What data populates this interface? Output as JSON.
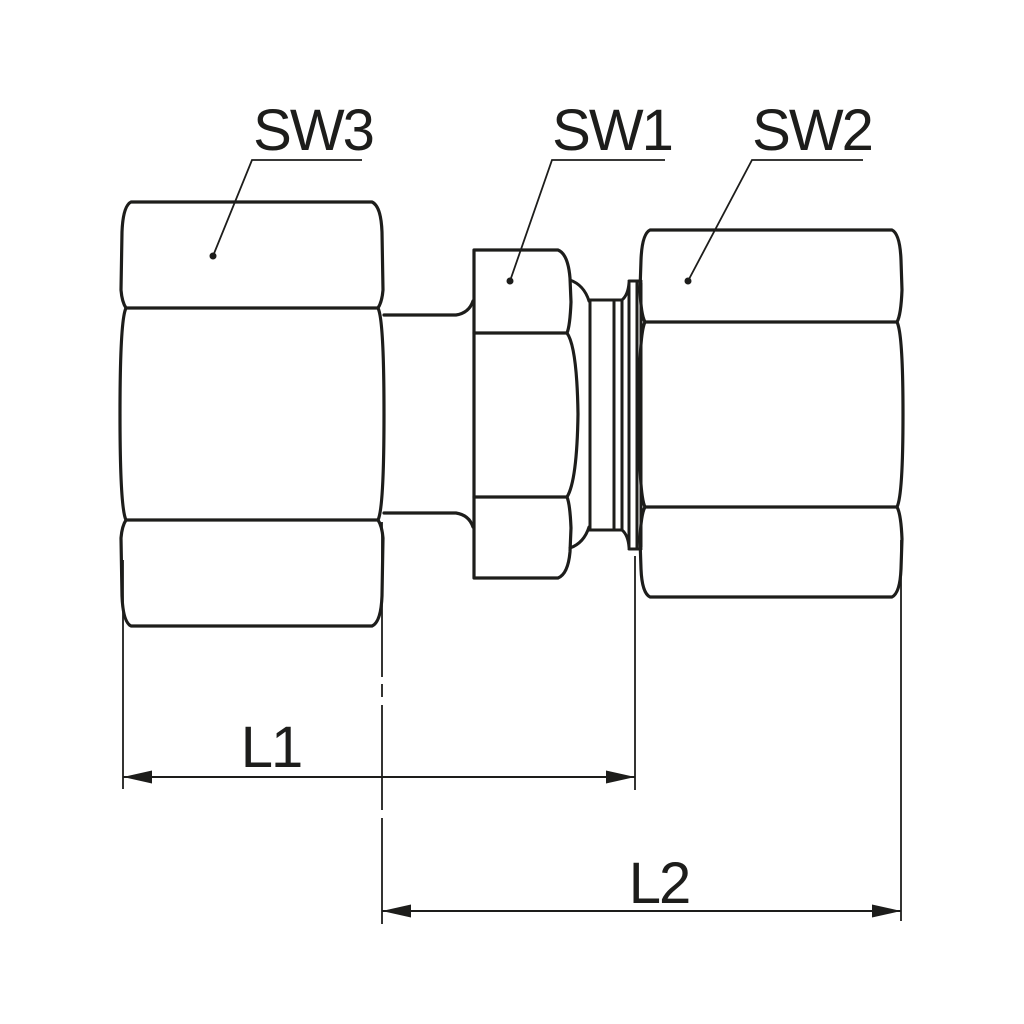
{
  "drawing": {
    "background": "#ffffff",
    "line_color": "#1d1d1b",
    "labels": {
      "sw3": "SW3",
      "sw1": "SW1",
      "sw2": "SW2"
    },
    "dimensions": {
      "l1": "L1",
      "l2": "L2"
    }
  }
}
